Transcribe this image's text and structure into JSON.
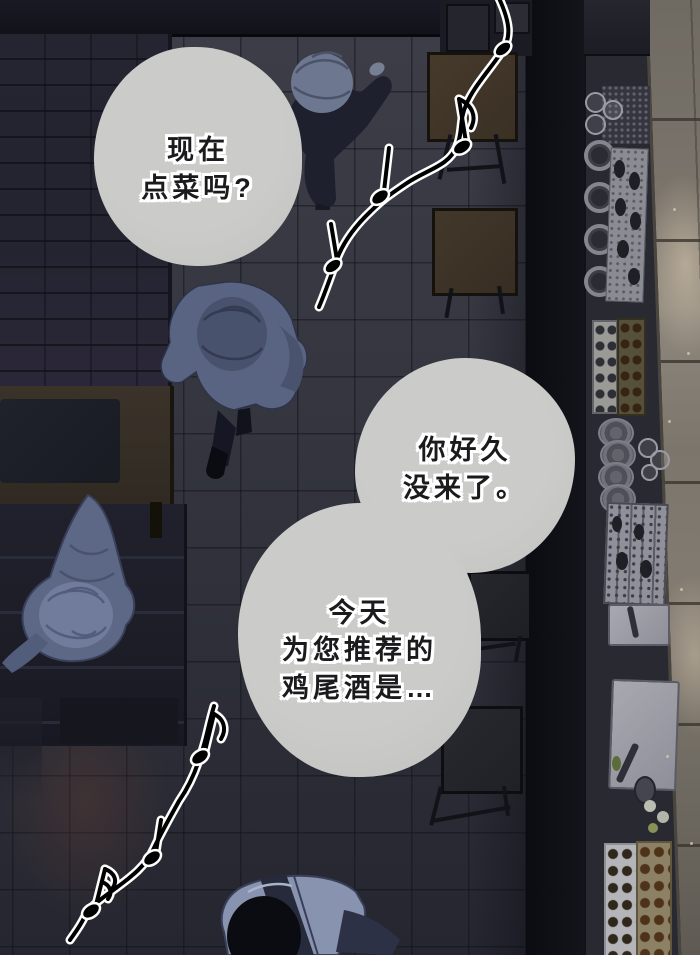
{
  "speech_bubbles": [
    {
      "id": "bubble-1",
      "lines": [
        "现在",
        "点菜吗?"
      ]
    },
    {
      "id": "bubble-2",
      "lines": [
        "你好久",
        "没来了。"
      ]
    },
    {
      "id": "bubble-3",
      "lines": [
        "今天",
        "为您推荐的",
        "鸡尾酒是…"
      ]
    }
  ],
  "icons": {
    "music_notes_top": "music-note-string",
    "music_notes_bottom": "music-note-string"
  },
  "colors": {
    "bubble_fill": "#c7c7c5",
    "bubble_text": "#1b1b1e",
    "text_outline": "#ffffff",
    "floor_dark": "#34353f",
    "floor_lit": "#8b847a",
    "counter_dark": "#0e0f15",
    "figure_navy": "#1e212d",
    "figure_blue": "#596482",
    "table_brown": "#40352a",
    "note_fill": "#000000",
    "note_outline": "#ffffff"
  }
}
